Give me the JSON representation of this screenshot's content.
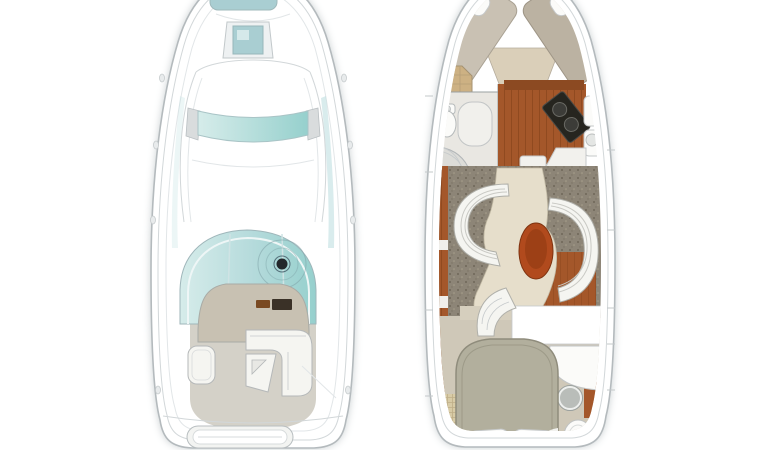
{
  "scene": {
    "kind": "boat-floor-plan",
    "views": [
      "exterior-deck-plan",
      "interior-cabin-plan"
    ]
  },
  "colors": {
    "background": "#ffffff",
    "hull_outline": "#b4babd",
    "deck_seam": "#d2d7d9",
    "glass_teal": "#b4dadb",
    "glass_teal_light": "#d6ecea",
    "glass_teal_deep": "#96d0cd",
    "hatch_teal": "#a9ced2",
    "cockpit_floor": "#d4d1c8",
    "console_tan": "#c8c1b2",
    "control_brown": "#7a4a22",
    "control_dark": "#3a3127",
    "seat_white": "#f5f5f1",
    "helm_black": "#23272b",
    "wood_rust": "#a4572a",
    "wood_line": "#7c3d15",
    "wood_band": "#8c4a22",
    "carpet_taupe": "#8d8577",
    "floor_cream": "#e6decb",
    "floor_tan": "#d6cfbe",
    "aft_floor": "#cfc8b8",
    "mattress_light": "#c9c1b3",
    "mattress_dark": "#bbb2a2",
    "berth_wedge": "#dacfb9",
    "bed_sage": "#b2af9d",
    "table_rust": "#b14a1d",
    "table_core": "#8f3a12",
    "stove_black": "#26251f",
    "burner_gray": "#3c3c38",
    "wicker_tan": "#cdb183",
    "mat_straw": "#d8cba6",
    "fixture_white": "#fbfbf9",
    "sink_gray": "#b9bdb9",
    "pad_white": "#f3f4f2",
    "head_floor": "#e9e7e2",
    "shower_gray": "#dcdcd8"
  },
  "plans": {
    "exterior": {
      "parts": [
        "anchor-hatch",
        "foredeck-hatch",
        "skylight-band",
        "cabin-top",
        "windshield-arch",
        "helm-console",
        "helm-wheel",
        "cockpit-floor",
        "port-lounger",
        "cockpit-lounge",
        "transom-sunpad",
        "swim-platform",
        "cleats"
      ]
    },
    "interior": {
      "parts": [
        "v-berth",
        "berth-pillows",
        "wicker-cabinet",
        "head-toilet",
        "head-vanity",
        "shower",
        "galley-sole",
        "galley-stove",
        "galley-counter",
        "salon-carpet",
        "salon-sofa-port",
        "salon-sofa-starboard",
        "dinette-table",
        "companionway-steps",
        "mid-bulkhead",
        "aft-berth",
        "aft-pillows",
        "aft-sink",
        "aft-toilet",
        "straw-mat"
      ]
    }
  }
}
